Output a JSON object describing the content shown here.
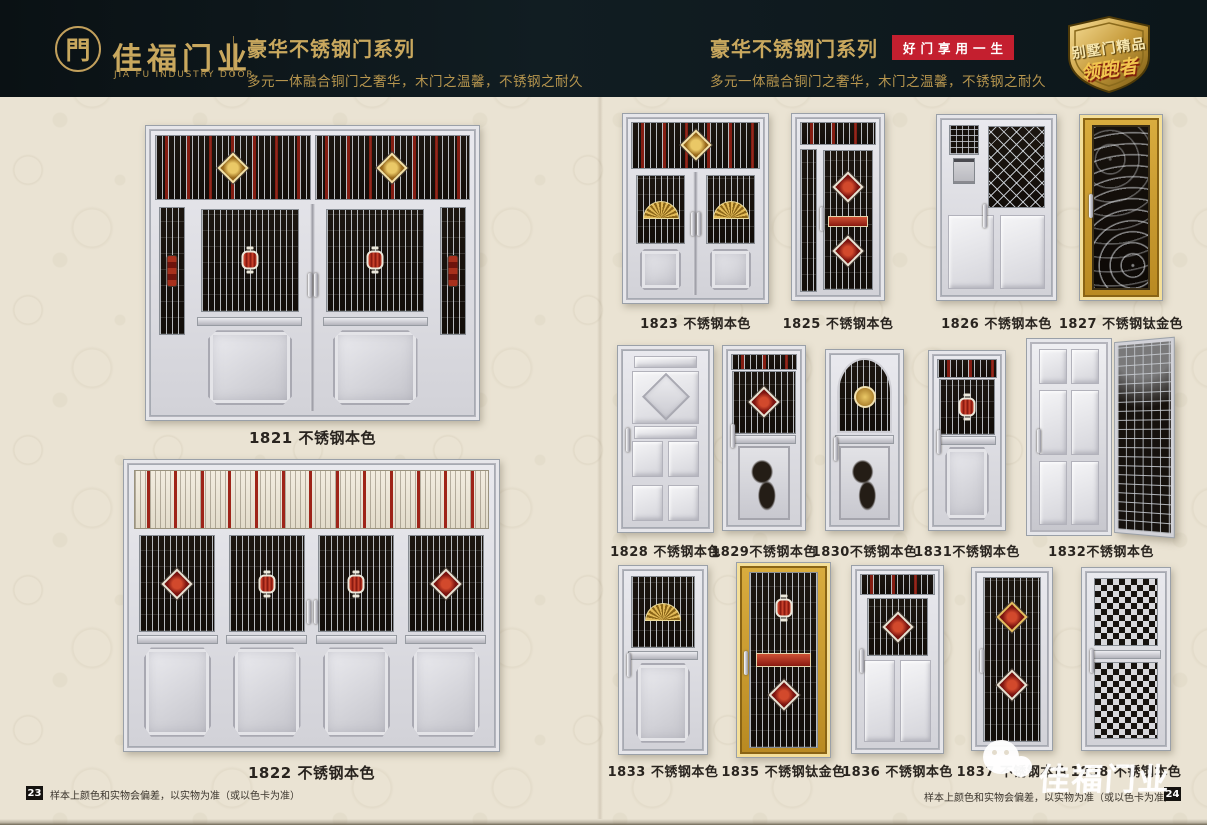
{
  "header": {
    "logo": {
      "symbol": "門",
      "brand": "佳福门业",
      "brand_en": "JIA FU INDUSTRY DOOR"
    },
    "left_series": {
      "title": "豪华不锈钢门系列",
      "subtitle": "多元一体融合铜门之奢华，木门之温馨，不锈钢之耐久"
    },
    "right_series": {
      "title": "豪华不锈钢门系列",
      "badge": "好门享用一生",
      "subtitle": "多元一体融合铜门之奢华，木门之温馨，不锈钢之耐久"
    },
    "shield": {
      "line1": "别墅门精品",
      "line2": "领跑者"
    }
  },
  "left_page": {
    "doors": [
      {
        "model": "1821",
        "finish": "不锈钢本色",
        "label": "1821 不锈钢本色"
      },
      {
        "model": "1822",
        "finish": "不锈钢本色",
        "label": "1822 不锈钢本色"
      }
    ],
    "footer": {
      "page_number": "23",
      "note": "样本上颜色和实物会偏差，以实物为准（或以色卡为准）"
    }
  },
  "right_page": {
    "rows": [
      {
        "doors": [
          {
            "model": "1823",
            "finish": "不锈钢本色",
            "label": "1823 不锈钢本色"
          },
          {
            "model": "1825",
            "finish": "不锈钢本色",
            "label": "1825 不锈钢本色"
          },
          {
            "model": "1826",
            "finish": "不锈钢本色",
            "label": "1826 不锈钢本色"
          },
          {
            "model": "1827",
            "finish": "不锈钢钛金色",
            "label": "1827 不锈钢钛金色"
          }
        ]
      },
      {
        "doors": [
          {
            "model": "1828",
            "finish": "不锈钢本色",
            "label": "1828 不锈钢本色"
          },
          {
            "model": "1829",
            "finish": "不锈钢本色",
            "label": "1829不锈钢本色"
          },
          {
            "model": "1830",
            "finish": "不锈钢本色",
            "label": "1830不锈钢本色"
          },
          {
            "model": "1831",
            "finish": "不锈钢本色",
            "label": "1831不锈钢本色"
          },
          {
            "model": "1832",
            "finish": "不锈钢本色",
            "label": "1832不锈钢本色"
          }
        ]
      },
      {
        "doors": [
          {
            "model": "1833",
            "finish": "不锈钢本色",
            "label": "1833 不锈钢本色"
          },
          {
            "model": "1835",
            "finish": "不锈钢钛金色",
            "label": "1835 不锈钢钛金色"
          },
          {
            "model": "1836",
            "finish": "不锈钢本色",
            "label": "1836 不锈钢本色"
          },
          {
            "model": "1837",
            "finish": "不锈钢本色",
            "label": "1837 不锈钢本色"
          },
          {
            "model": "1838",
            "finish": "不锈钢本色",
            "label": "1838 不锈钢本色"
          }
        ]
      }
    ],
    "footer": {
      "page_number": "24",
      "note": "样本上颜色和实物会偏差，以实物为准（或以色卡为准）"
    },
    "watermark": "佳福门业"
  },
  "colors": {
    "gold": "#c9a85e",
    "badge_red": "#c41f2f",
    "header_bg": "#0d171c",
    "page_bg": "#eae3d3",
    "label_text": "#29241f"
  }
}
